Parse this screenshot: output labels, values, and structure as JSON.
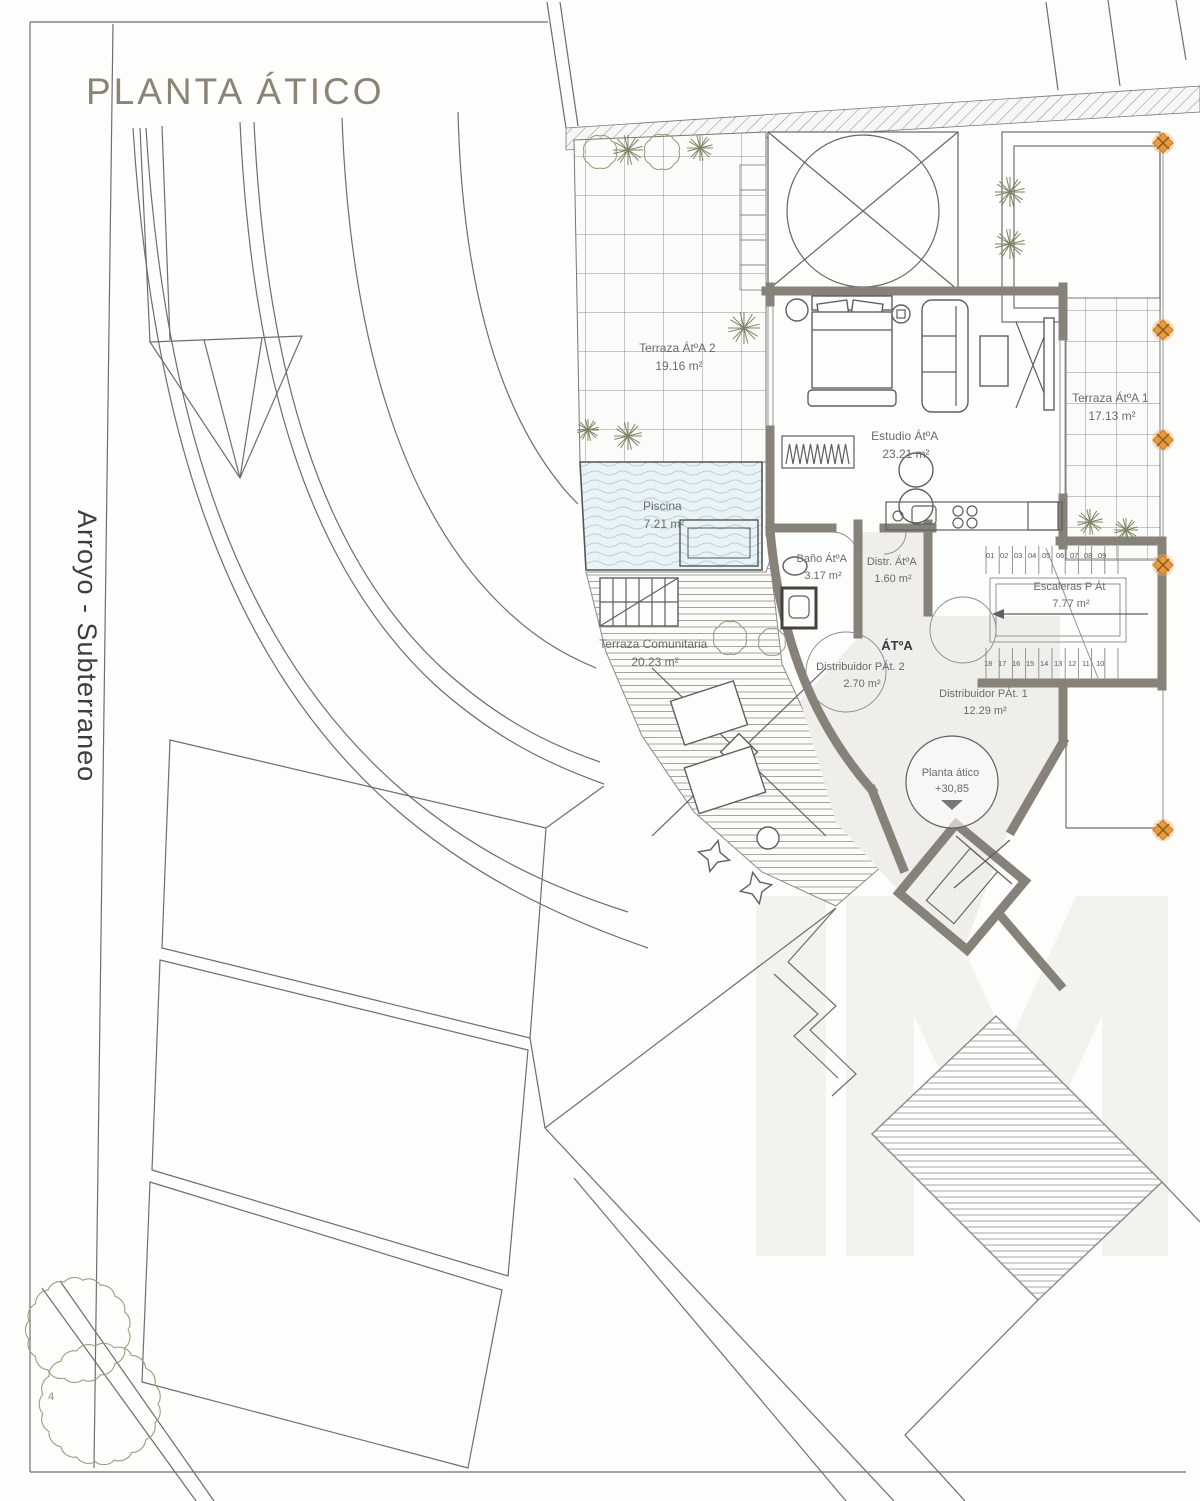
{
  "title": "PLANTA ÁTICO",
  "street_label": "Arroyo - Subterraneo",
  "rooms": {
    "terraza_2": {
      "name": "Terraza ÁtºA 2",
      "area": "19.16 m²"
    },
    "piscina": {
      "name": "Piscina",
      "area": "7.21 m²"
    },
    "estudio": {
      "name": "Estudio ÁtºA",
      "area": "23.21 m²"
    },
    "terraza_1": {
      "name": "Terraza ÁtºA 1",
      "area": "17.13 m²"
    },
    "bano": {
      "name": "Baño ÁtºA",
      "area": "3.17 m²"
    },
    "distribuidor_atico": {
      "name": "Distr. ÁtºA",
      "area": "1.60 m²"
    },
    "escaleras": {
      "name": "Escaleras P Át",
      "area": "7.77 m²"
    },
    "distribuidor_pat_2": {
      "name": "Distribuidor PÁt. 2",
      "area": "2.70 m²"
    },
    "distribuidor_pat_1": {
      "name": "Distribuidor PÁt. 1",
      "area": "12.29 m²"
    },
    "terraza_comunitaria": {
      "name": "Terraza Comunitaria",
      "area": "20.23 m²"
    }
  },
  "unit_label": "ÁTºA",
  "level_marker": {
    "label": "Planta ático",
    "value": "+30,85"
  },
  "stairs": {
    "up_numbers": [
      "01",
      "02",
      "03",
      "04",
      "05",
      "06",
      "07",
      "08",
      "09"
    ],
    "down_numbers": [
      "18",
      "17",
      "16",
      "15",
      "14",
      "13",
      "12",
      "11",
      "10"
    ]
  },
  "tree_label": "4",
  "colors": {
    "wall": "#86827a",
    "accent_marker": "#e0922f",
    "pool_water": "#e9f3f5",
    "pool_wave": "#b3d2d8",
    "plant": "#98a07e",
    "title": "#8b8475",
    "line": "#6e6e6e",
    "watermark": "#f2f2ee"
  }
}
